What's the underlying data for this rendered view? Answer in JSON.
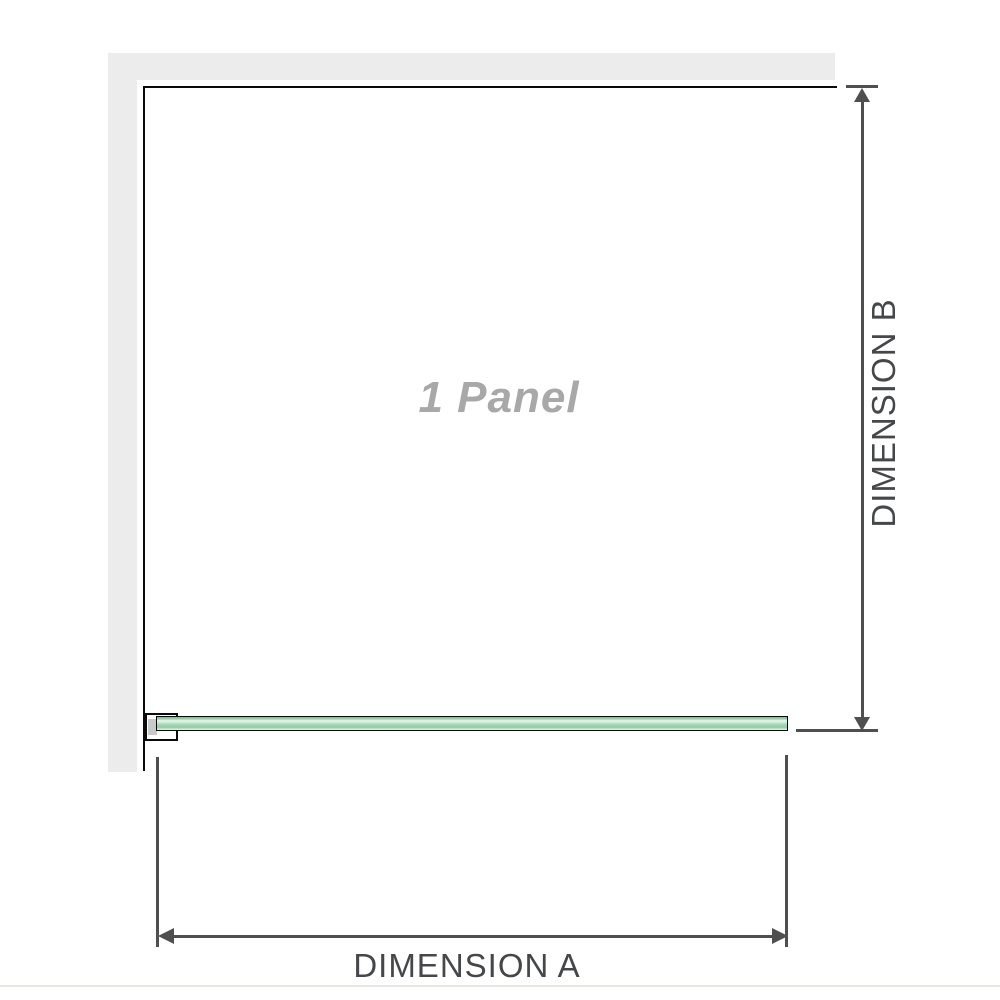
{
  "diagram": {
    "panel_label": "1 Panel",
    "dimensions": {
      "a_label": "DIMENSION A",
      "b_label": "DIMENSION B"
    },
    "colors": {
      "wall": "#ececec",
      "outline": "#0a0a0a",
      "dimension": "#4f4f4f",
      "label": "#45474a",
      "watermark": "#a8a8a8",
      "glass": "#93cca7",
      "glass-light": "#e9f7ee",
      "bracket-fill": "#ffffff",
      "bracket-shadow": "#c9c9c9",
      "hairline": "#e9e7e1"
    }
  }
}
